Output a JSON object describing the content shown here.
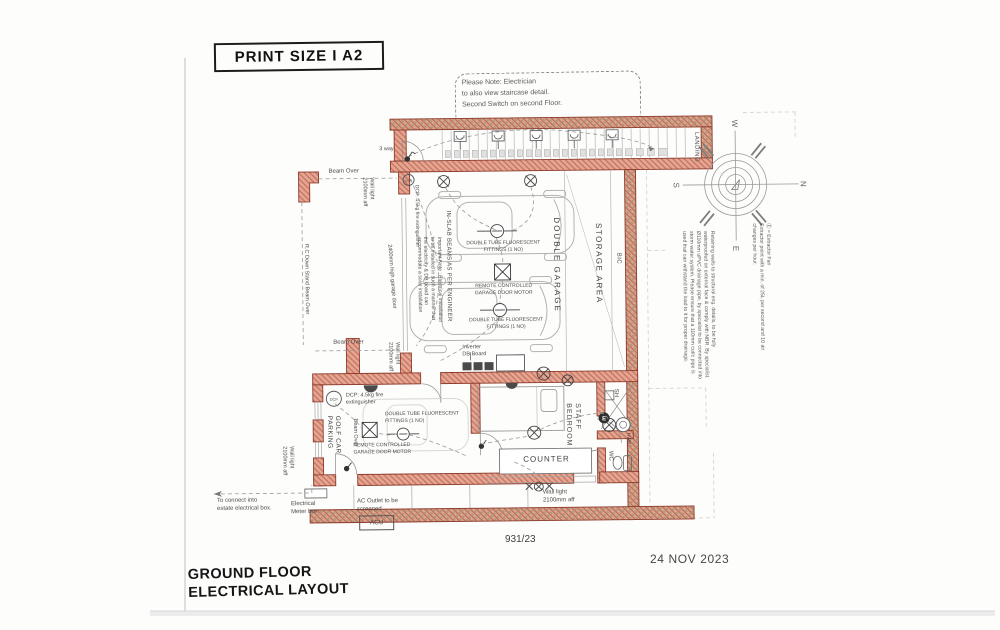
{
  "header": {
    "print_size": "PRINT SIZE  I  A2",
    "note": "Please Note: Electrician\nto also view staircase detail.\nSecond Switch on second Floor."
  },
  "titleblock": {
    "title": "GROUND FLOOR\nELECTRICAL LAYOUT",
    "drawing_number": "931/23",
    "date": "24 NOV 2023"
  },
  "compass": {
    "north": "N",
    "south": "S",
    "east": "E",
    "west": "W"
  },
  "rooms": {
    "double_garage": "DOUBLE GARAGE",
    "storage_area": "STORAGE AREA",
    "bic": "BIC",
    "landing": "LANDING",
    "staff_bedroom": "STAFF\nBEDROOM",
    "counter": "COUNTER",
    "golf_car_parking": "GOLF CAR\nPARKING",
    "shower": "SH",
    "wc": "WC",
    "hwb": "HWB"
  },
  "labels": {
    "three_way": "3 way",
    "beam_over": "Beam Over",
    "rc_beam": "R.C Down Stand Beam Over",
    "wall_light": "Wall light\n2100mm aff",
    "garage_door": "2400mm high garage door",
    "dcp_abbr": "DCP",
    "dcp": "DCP: 4.5kg fire\nextinguisher",
    "dcp_rotated": "DCP: 4.5kg fire extinguisher",
    "fluorescent": "DOUBLE TUBE FLUORESCENT\nFITTINGS (1 NO)",
    "motor": "REMOTE CONTROLLED\nGARAGE DOOR MOTOR",
    "inslab": "IN-SLAB BEAMS AS PER ENGINEER",
    "important_note": "Important Note : Electrical installation\nto be installed in such a manner that\nthe electricity & DB board can\naccommodate a solar installation",
    "inverter": "Inverter\nDB Board",
    "meter": "Electrical\nMeter box",
    "ac_outlet": "AC Outlet to be\nscreened",
    "acu": "ACU",
    "estate": "To connect into\nestate electrical box.",
    "extractor_note": "Ⓔ = Extractor Fan\nExtractor point with a min. of 25L per second and 10 air\nchanges per hour.",
    "retaining_note": "Retaining walls to structural eng. details, to be fully\nwaterproofed on external face & comply with NBR. By specialist.\nØ110mm uPVC drainage pipe, by specialist to be connected into\nstorm water system. Please ensure that a 110mm cut/c pipe is\nused that can withstand the load to it for proper drainage."
  },
  "colors": {
    "wall": "#e4a692",
    "wall_line": "#8d3b2c",
    "hatch_green": "#7f9c5e",
    "ink": "#4c4c4c"
  }
}
